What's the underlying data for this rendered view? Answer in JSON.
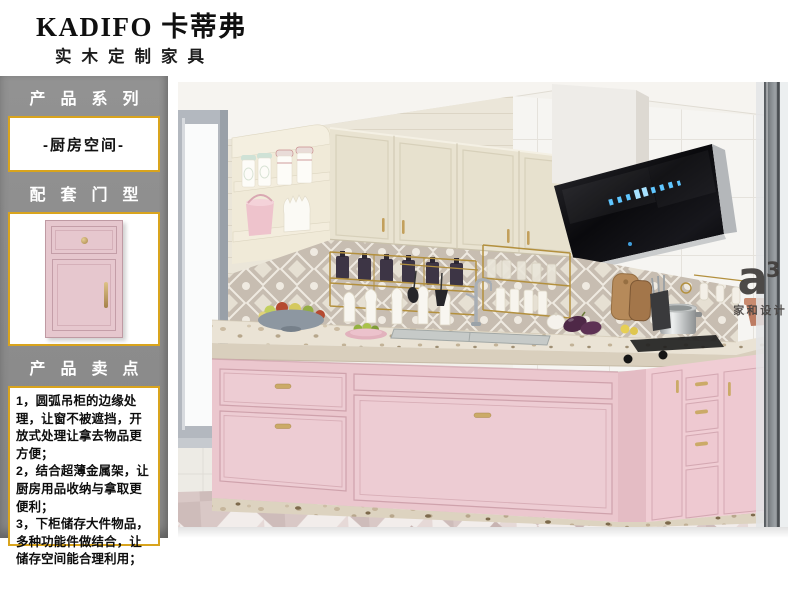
{
  "brand": {
    "title": "KADIFO 卡蒂弗",
    "subtitle": "实木定制家具"
  },
  "sidebar": {
    "series_title": "产品系列",
    "series_value": "-厨房空间-",
    "door_title": "配套门型",
    "points_title": "产品卖点",
    "selling_points": [
      "1，圆弧吊柜的边缘处理，让窗不被遮挡，开放式处理让拿去物品更方便；",
      "2，结合超薄金属架，让厨房用品收纳与拿取更便利；",
      "3，下柜储存大件物品，多种功能件做结合，让储存空间能合理利用；"
    ]
  },
  "watermark": {
    "logo": "a",
    "sup": "3",
    "label": "家和设计"
  },
  "colors": {
    "accent_gold": "#d9a41d",
    "sidebar_gray": "#8c8c8c",
    "cabinet_pink": "#ebc7ce",
    "upper_cabinet_cream": "#e9e3d1",
    "hood_black": "#141417",
    "backsplash_taupe": "#c7bdb1",
    "floor_triangle": "#d9c8c6",
    "brass": "#b3903e"
  }
}
